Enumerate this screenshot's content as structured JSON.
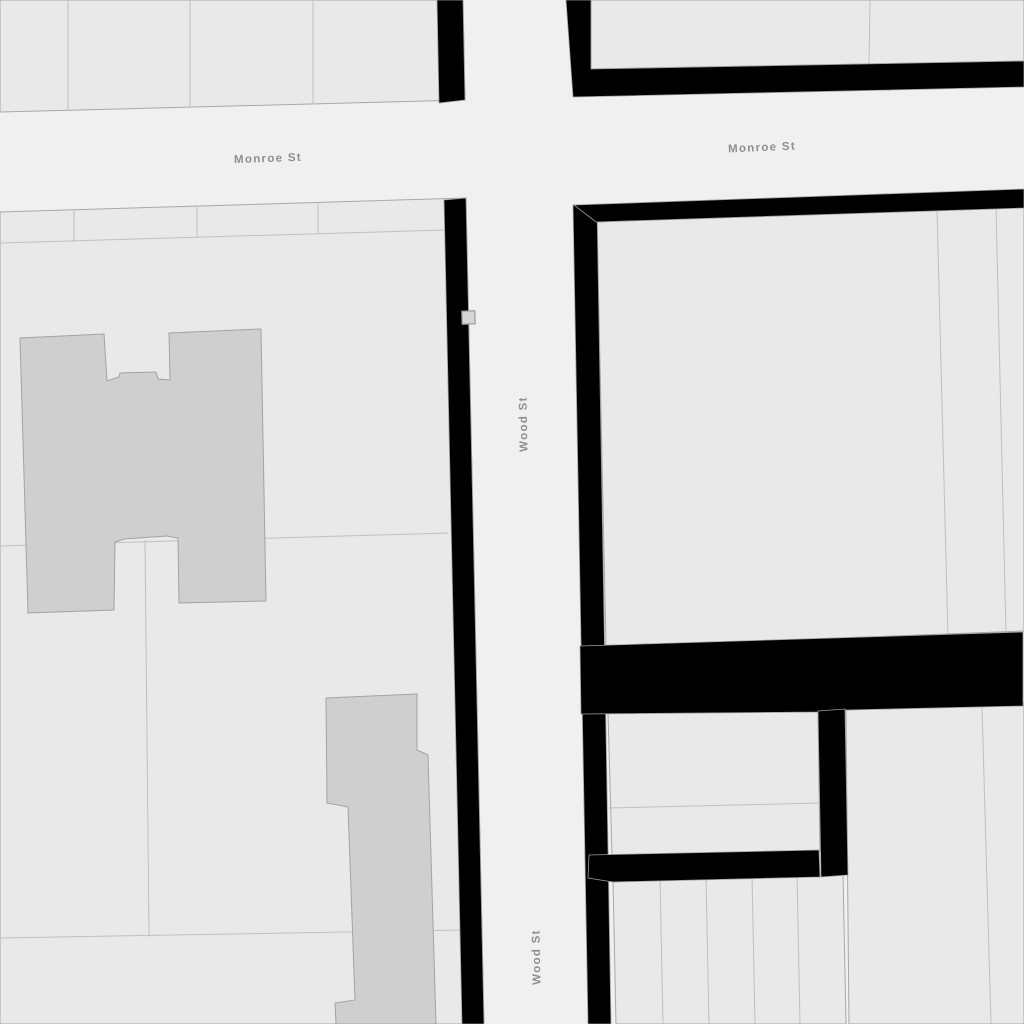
{
  "map": {
    "colors": {
      "street": "#f0f0f0",
      "parcel": "#e9e9e9",
      "parcel_outline": "#a8a8a8",
      "divider": "#c0c0c0",
      "building": "#cfcfcf",
      "building_outline": "#a3a3a3",
      "highlight": "#000000",
      "highlight_outline": "#9e9e9e",
      "label": "#8f8f8f",
      "label_halo": "#f0f0f0",
      "marker_fill": "#d6d6d6",
      "marker_outline": "#9b9b9b"
    },
    "street_labels": [
      {
        "name": "street-label-monroe-west",
        "text": "Monroe St",
        "x": 268,
        "y": 159,
        "rotation": -2
      },
      {
        "name": "street-label-monroe-east",
        "text": "Monroe St",
        "x": 762,
        "y": 148,
        "rotation": -2.5
      },
      {
        "name": "street-label-wood-north",
        "text": "Wood St",
        "x": 524,
        "y": 424,
        "rotation": -91
      },
      {
        "name": "street-label-wood-south",
        "text": "Wood St",
        "x": 537,
        "y": 957,
        "rotation": -91
      }
    ],
    "parcels": [
      {
        "name": "block-northwest",
        "points": "0,0 463,0 465,100 0,112"
      },
      {
        "name": "block-northeast-parcel",
        "points": "591,0 1024,0 1024,61 591,69"
      },
      {
        "name": "block-east-main-parcel",
        "points": "597,222 1024,206 1024,631 606,647"
      },
      {
        "name": "block-southeast-sub-parcel",
        "points": "608,713 818,710 820,852 612,855"
      },
      {
        "name": "block-southeast-right-parcel",
        "points": "846,710 1024,703 1024,1024 849,1024"
      },
      {
        "name": "block-southeast-lot-row",
        "points": "613,881 843,873 846,1024 616,1024"
      },
      {
        "name": "block-southwest",
        "points": "0,212 466,198 484,1024 0,1024"
      }
    ],
    "dividers": [
      {
        "name": "nw-lot-line-1",
        "points": "68,0 68,110"
      },
      {
        "name": "nw-lot-line-2",
        "points": "190,0 190,107"
      },
      {
        "name": "nw-lot-line-3",
        "points": "313,0 313,103"
      },
      {
        "name": "ne-lot-line",
        "points": "870,0 869,64"
      },
      {
        "name": "east-lot-line-1",
        "points": "937,210 948,637"
      },
      {
        "name": "east-lot-line-2",
        "points": "996,208 1006,634"
      },
      {
        "name": "se-sub-parcel-line",
        "points": "609,808 819,803"
      },
      {
        "name": "se-right-lot-line",
        "points": "982,707 991,1024"
      },
      {
        "name": "se-row-lot-line-1",
        "points": "660,878 663,1024"
      },
      {
        "name": "se-row-lot-line-2",
        "points": "706,877 709,1024"
      },
      {
        "name": "se-row-lot-line-3",
        "points": "752,875 755,1024"
      },
      {
        "name": "se-row-lot-line-4",
        "points": "797,874 800,1024"
      },
      {
        "name": "sw-top-band-line",
        "points": "0,243 445,230"
      },
      {
        "name": "sw-top-lot-line-1",
        "points": "74,210 74,242"
      },
      {
        "name": "sw-top-lot-line-2",
        "points": "197,206 197,238"
      },
      {
        "name": "sw-top-lot-line-3",
        "points": "318,203 318,234"
      },
      {
        "name": "sw-mid-lot-line",
        "points": "0,546 448,533"
      },
      {
        "name": "sw-vertical-lot-line",
        "points": "145,540 149,937"
      },
      {
        "name": "sw-lower-lot-line",
        "points": "0,938 463,930"
      }
    ],
    "highlights": [
      {
        "name": "highlight-strip-nw",
        "points": "437,0 463,0 465,100 439,103"
      },
      {
        "name": "highlight-frame-ne",
        "points": "566,0 591,0 591,69 1024,61 1024,87 573,97"
      },
      {
        "name": "highlight-strip-sw-wood",
        "points": "444,200 466,198 484,1024 462,1024"
      },
      {
        "name": "highlight-strip-east-wood",
        "points": "573,205 597,205 611,1024 588,1024"
      },
      {
        "name": "highlight-band-east-top",
        "points": "574,205 1024,189 1024,208 596,222"
      },
      {
        "name": "highlight-band-east-mid",
        "points": "580,646 1023,632 1023,706 846,710 820,712 581,714"
      },
      {
        "name": "highlight-strip-se-inner",
        "points": "818,711 845,709 848,875 821,877"
      },
      {
        "name": "highlight-band-se-bottom",
        "points": "589,855 819,850 820,877 613,882 588,878"
      }
    ],
    "buildings": [
      {
        "name": "building-h-shaped",
        "points": "20,338 104,334 107,381 119,377 120,373 156,372 158,379 170,380 169,333 261,329 266,601 179,603 178,538 167,536 124,539 115,542 114,610 28,613"
      },
      {
        "name": "building-south",
        "points": "326,698 417,694 417,750 428,755 436,1024 336,1024 335,1003 355,1000 348,807 327,803"
      }
    ],
    "marker": {
      "x": 462,
      "y": 311,
      "w": 13,
      "h": 13,
      "rotation": -2
    }
  }
}
